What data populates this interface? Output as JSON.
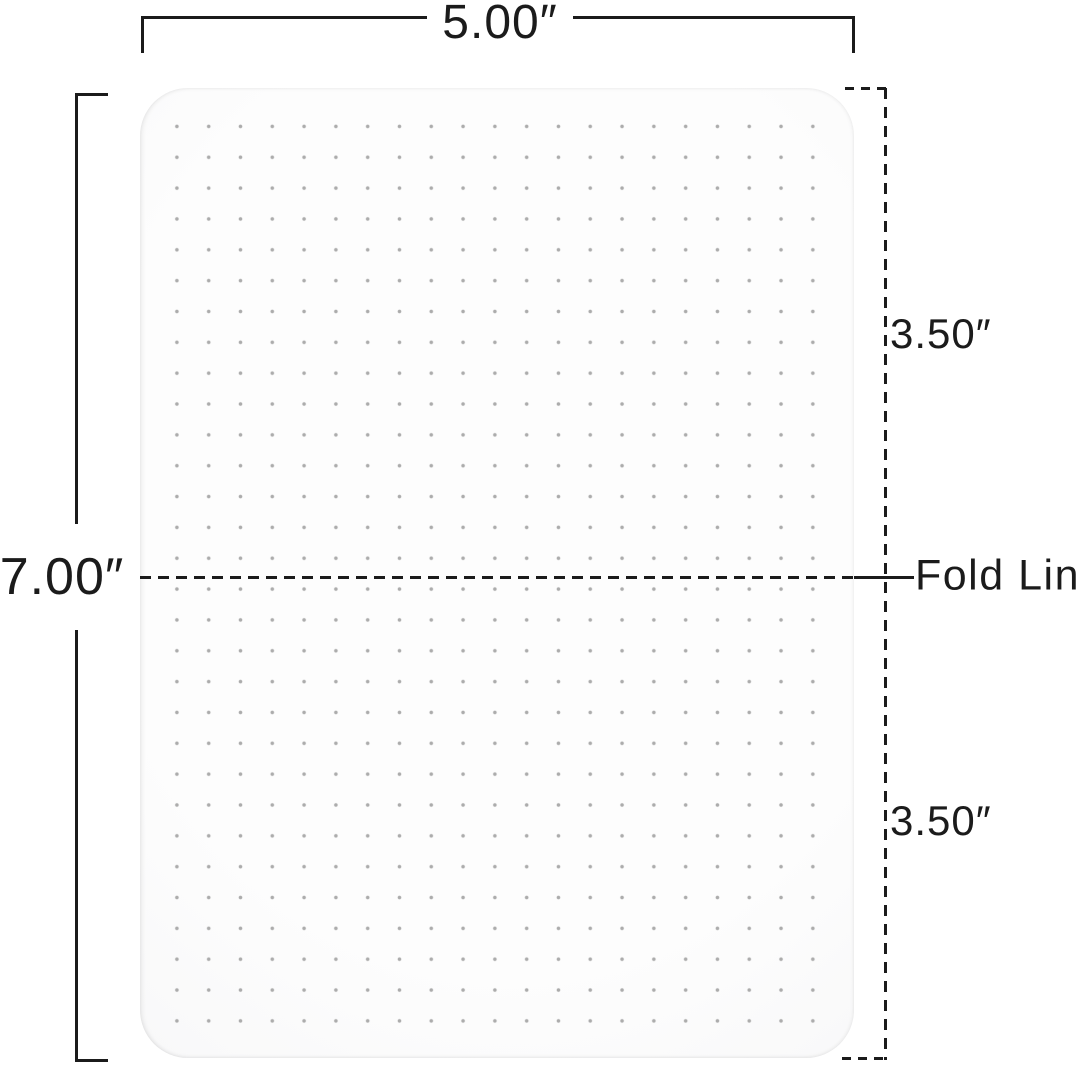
{
  "diagram": {
    "type": "folding-mat-dimension-diagram",
    "labels": {
      "width": "5.00″",
      "height": "7.00″",
      "top_half": "3.50″",
      "bottom_half": "3.50″",
      "fold_line": "Fold Line"
    },
    "values_inches": {
      "width": 5.0,
      "height": 7.0,
      "top_half": 3.5,
      "bottom_half": 3.5
    },
    "colors": {
      "line": "#1b1b1b",
      "dot": "#acacac",
      "mat_center": "#fdfdfd",
      "mat_edge": "#ededee",
      "background": "#ffffff"
    }
  }
}
